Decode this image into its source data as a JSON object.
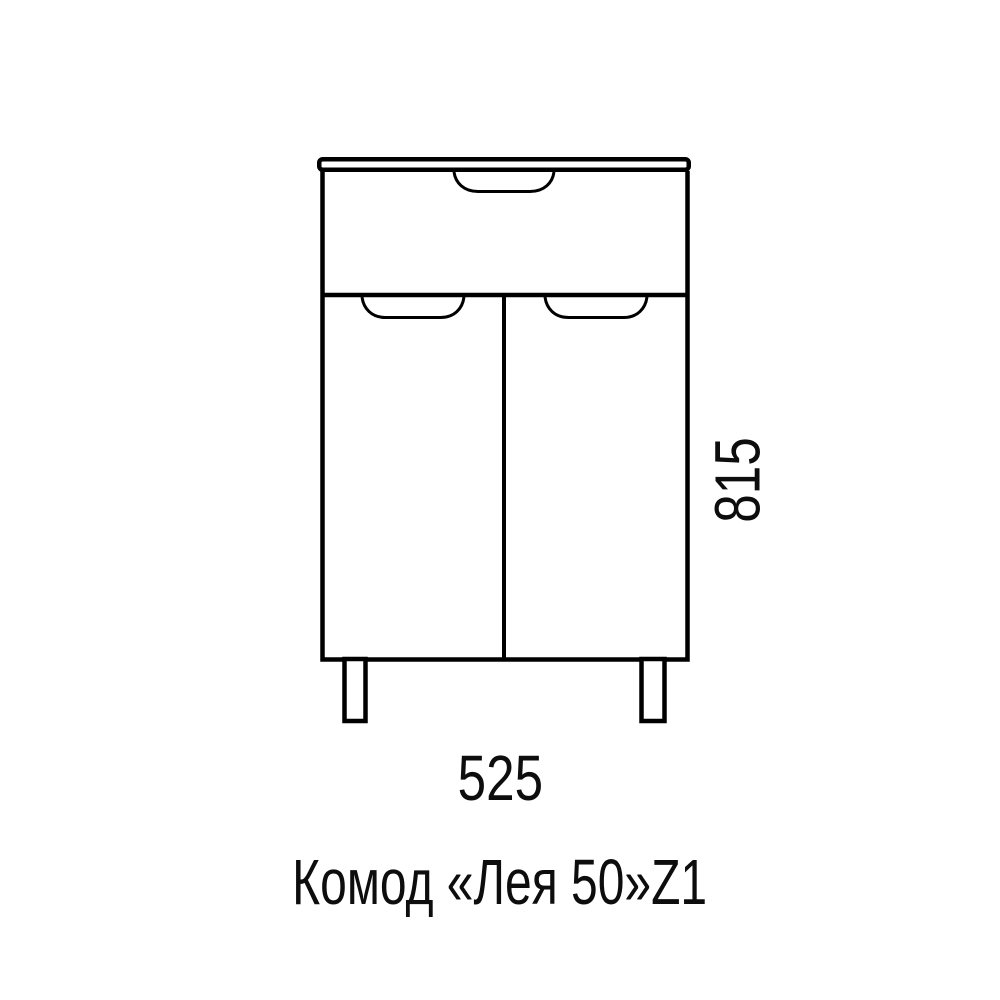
{
  "page": {
    "background_color": "#ffffff"
  },
  "drawing": {
    "line_color": "#000000",
    "title": "Комод «Лея 50»Z1",
    "width_dimension": "525",
    "height_dimension": "815"
  }
}
